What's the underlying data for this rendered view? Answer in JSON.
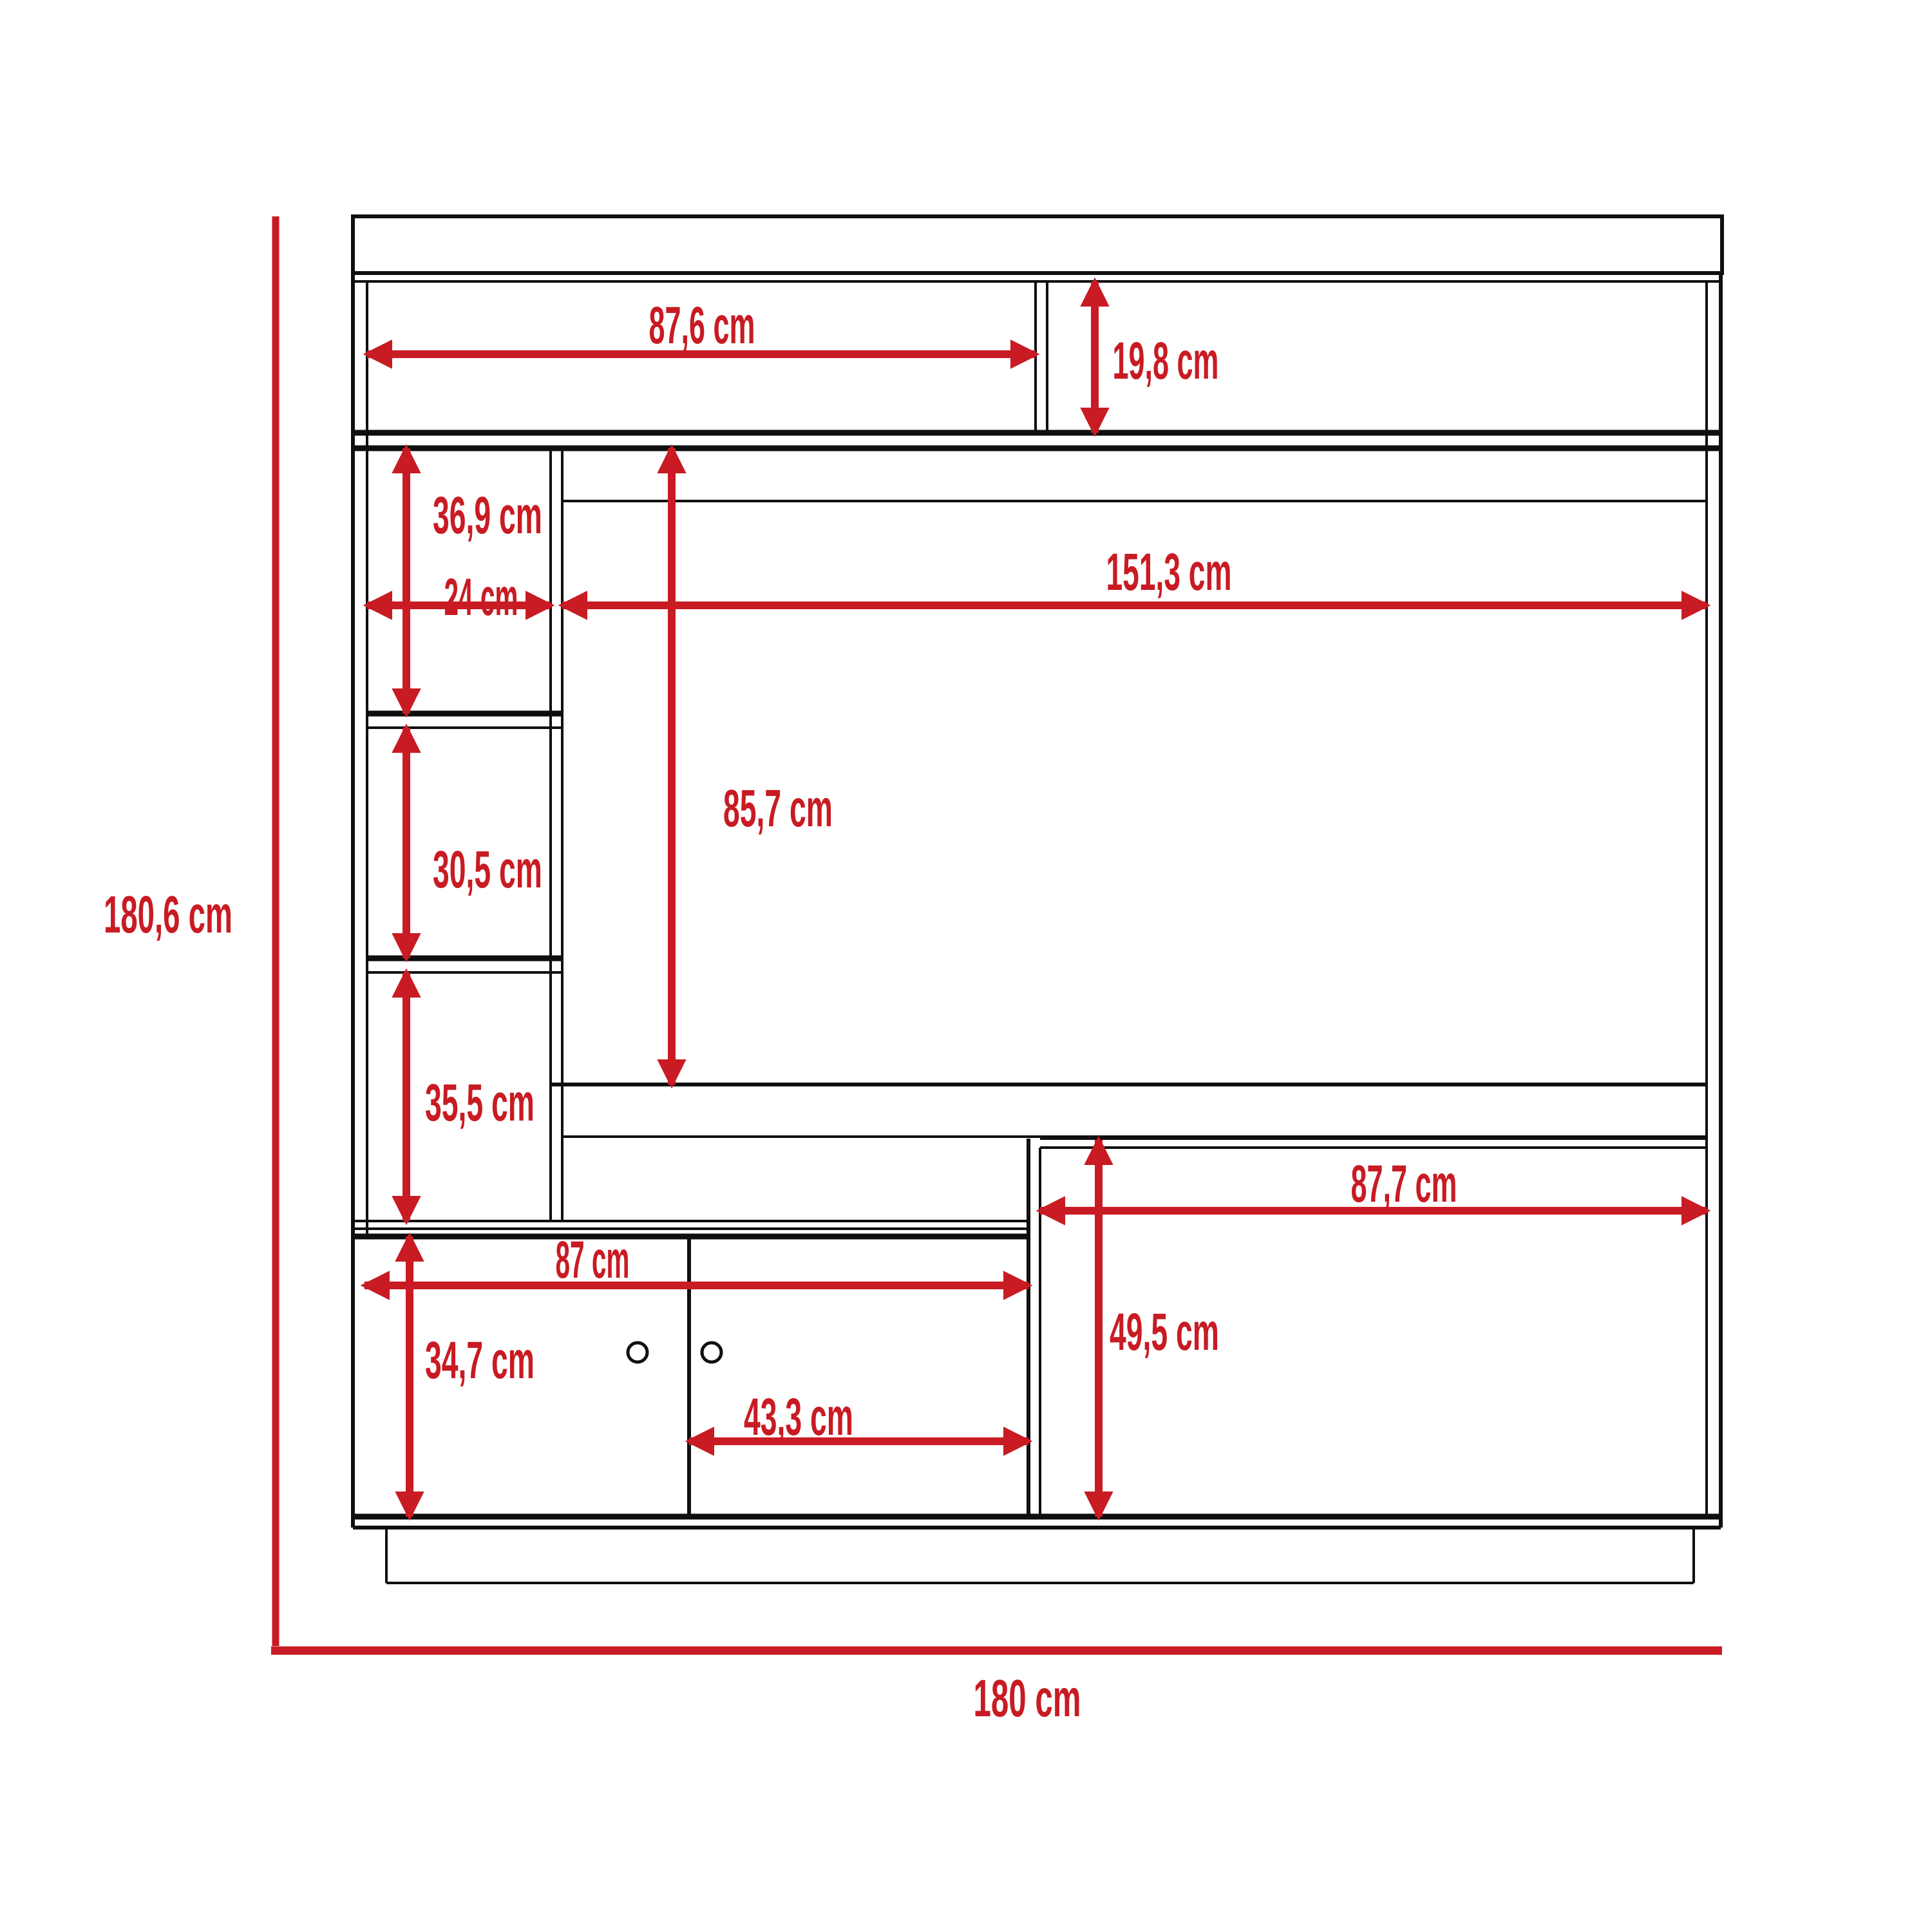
{
  "page": {
    "background": "#ffffff"
  },
  "diagram": {
    "description": "Front-view dimension drawing of an entertainment center wall unit",
    "unit": "cm",
    "accent_color": "#c81b23",
    "line_color": "#0f0f0f",
    "overall": {
      "height": "180,6 cm",
      "width": "180 cm"
    },
    "dims": {
      "top_shelf_width": "87,6 cm",
      "top_shelf_height": "19,8 cm",
      "upper_left_cubby_height": "36,9 cm",
      "left_column_width": "24 cm",
      "tv_opening_width": "151,3 cm",
      "tv_opening_height": "85,7 cm",
      "middle_left_cubby_height": "30,5 cm",
      "lower_left_cubby_height": "35,5 cm",
      "right_cabinet_width": "87,7 cm",
      "right_cabinet_height": "49,5 cm",
      "door_section_width": "87 cm",
      "door_section_height": "34,7 cm",
      "right_door_width": "43,3 cm"
    }
  }
}
